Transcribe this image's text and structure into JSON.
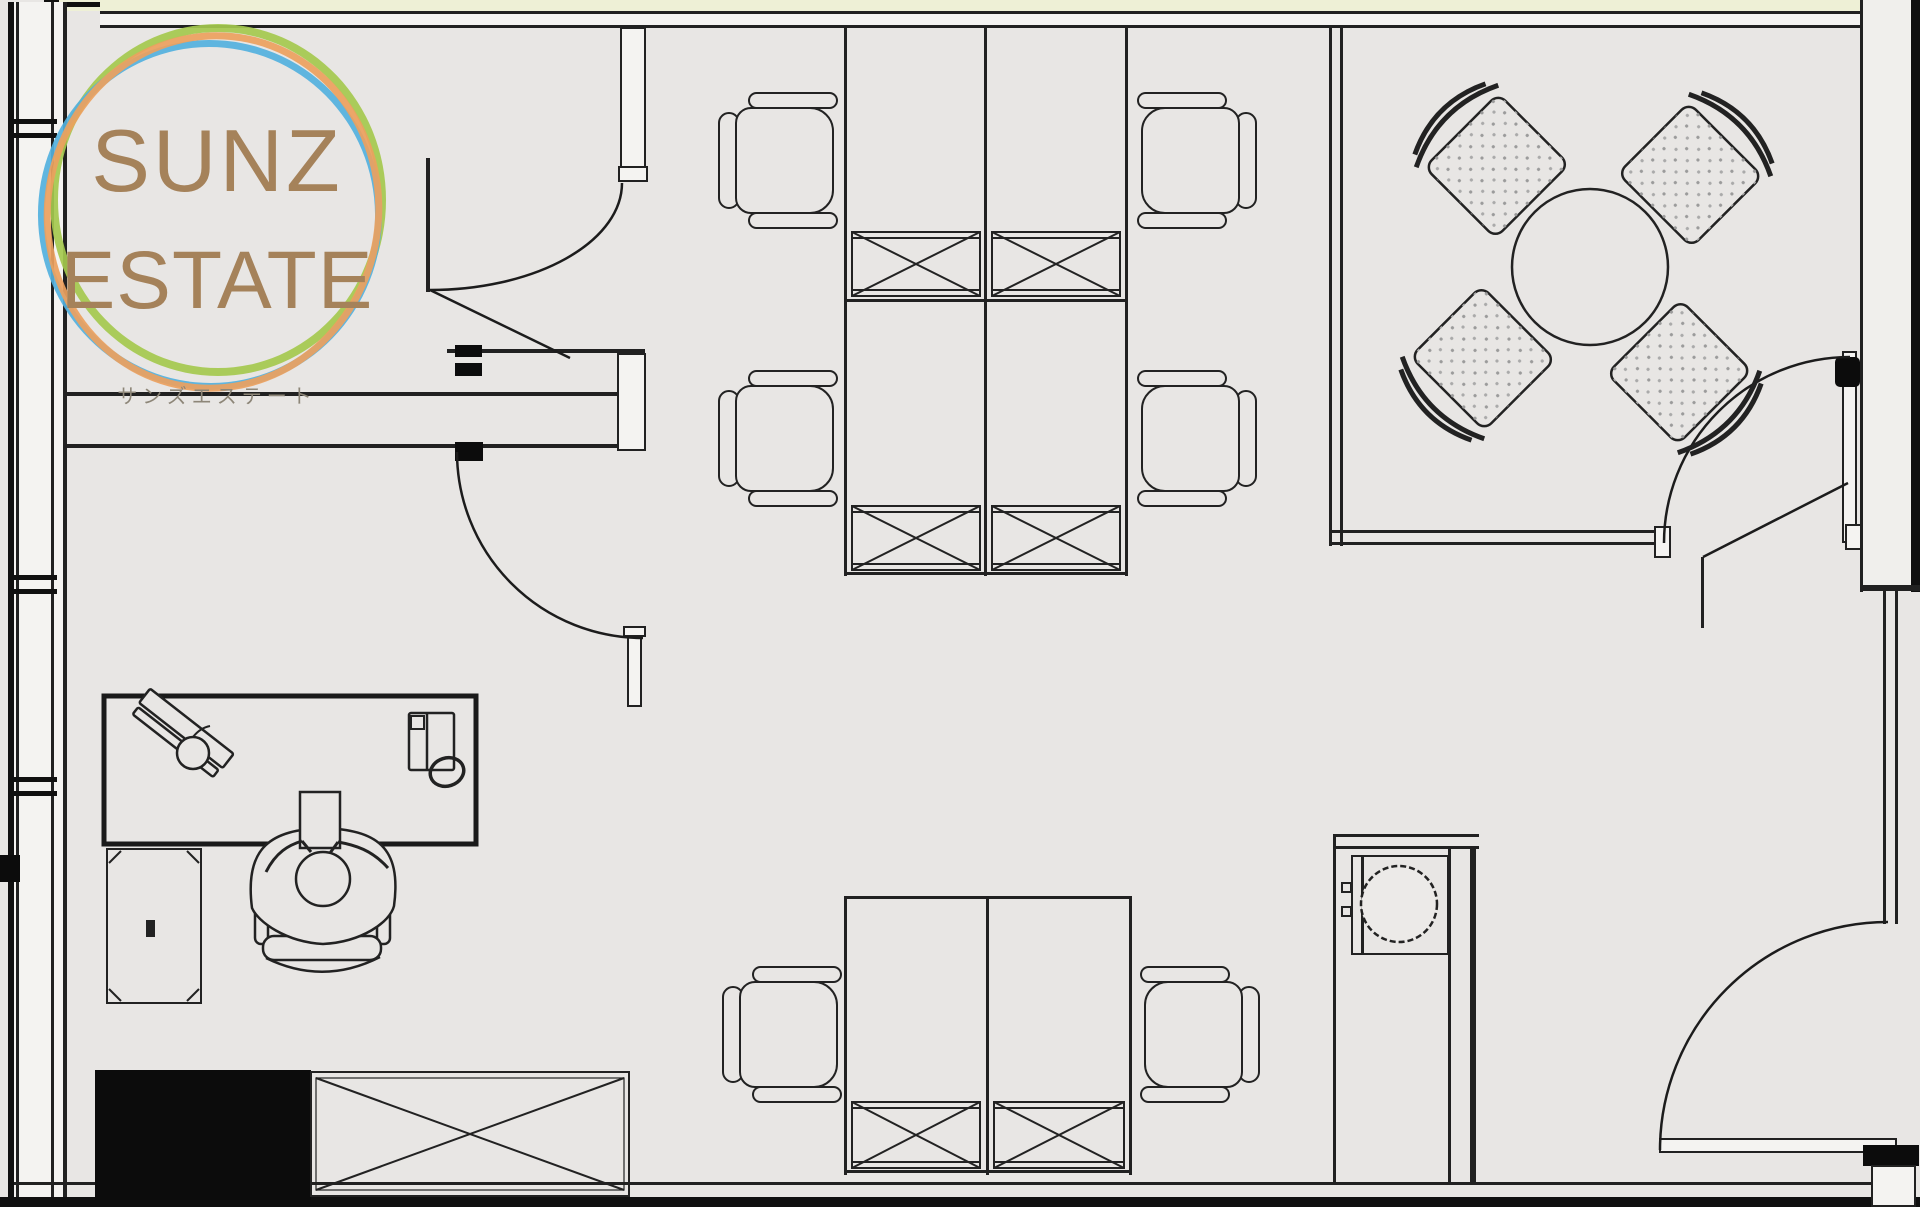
{
  "app": {
    "title": "SUNZ ESTATE office floor plan"
  },
  "logo": {
    "line1": "SUNZ",
    "line2": "ESTATE",
    "subtitle": "サンズエステート"
  },
  "colors": {
    "floor": "#e8e6e4",
    "line": "#212121",
    "wall-dark": "#101010",
    "wall-fill": "#f4f3f1",
    "accent-strip": "#eef0d6",
    "black-fill": "#0c0c0c",
    "logo-text": "#a5825a",
    "ring-green": "#a4c94e",
    "ring-blue": "#52b1de",
    "ring-orange": "#eba15e"
  },
  "inventory": {
    "workstation_desks": 6,
    "task_chairs": 7,
    "desk_drawer_units": 6,
    "storage_unit": 1,
    "meeting_table": 1,
    "meeting_chairs": 4,
    "reception_desk": 1,
    "side_cabinet": 1,
    "toilet": 1,
    "swing_doors": 4,
    "people": 1
  }
}
